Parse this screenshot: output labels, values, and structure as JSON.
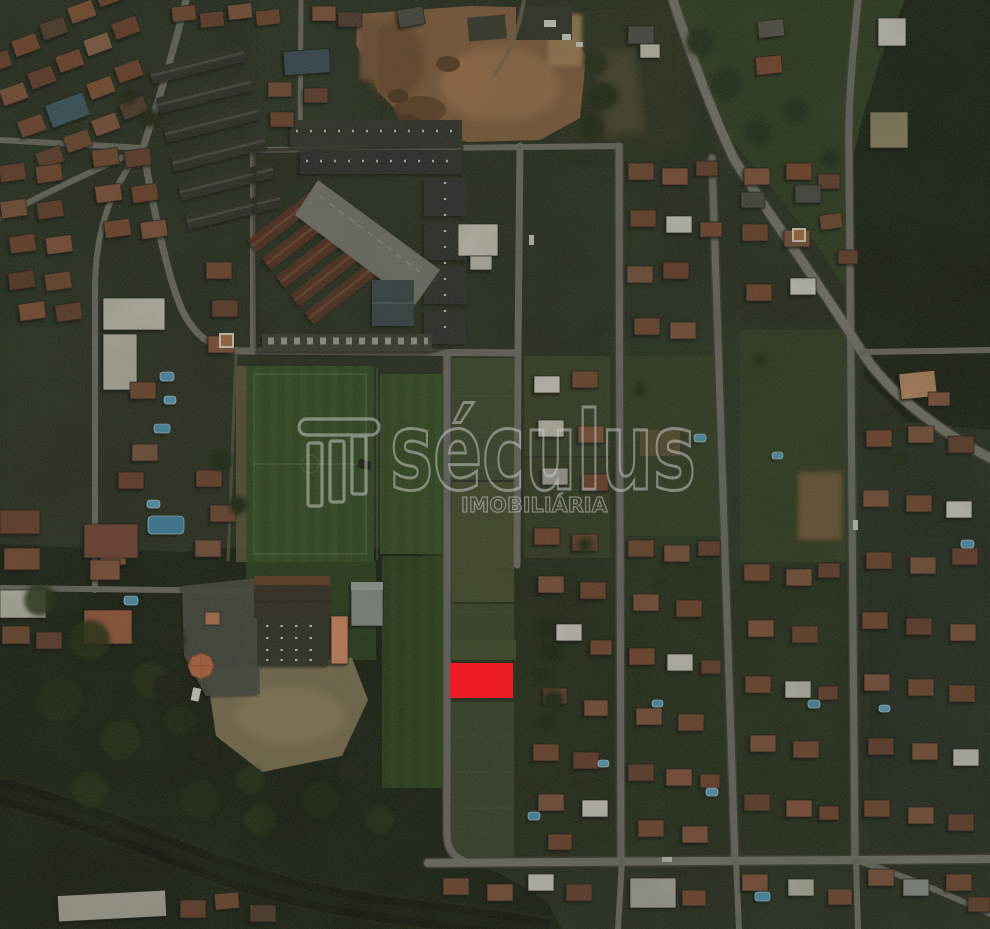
{
  "image": {
    "kind": "satellite-aerial-photo",
    "subject": "residential neighborhood with land lot highlighted for sale",
    "width": 990,
    "height": 929
  },
  "watermark": {
    "brand": "séculus",
    "subtitle": "IMOBILIÁRIA",
    "color": "#cccccc",
    "logo": "column-icon"
  },
  "marker": {
    "name": "highlighted-lot",
    "color": "#ed1c24",
    "x": 450,
    "y": 663,
    "width": 63,
    "height": 35
  },
  "palette": {
    "ground": "#232a1c",
    "forest": "#131a0d",
    "field": "#2f471f",
    "dirt": "#8a5e3e",
    "road": "#716f68",
    "water": "#0c100a",
    "roof_red": "#7a452f",
    "roof_white": "#d9d6cc",
    "pool_blue": "#4f9ec7"
  },
  "features": [
    {
      "name": "construction-dirt-area",
      "area": "top-center"
    },
    {
      "name": "apartment-row-complex",
      "area": "upper-left-center"
    },
    {
      "name": "townhouse-superblock",
      "area": "upper-center"
    },
    {
      "name": "soccer-fields",
      "area": "center-left"
    },
    {
      "name": "school-with-orange-gazebo",
      "area": "lower-left-center"
    },
    {
      "name": "river",
      "area": "bottom-left"
    },
    {
      "name": "forest",
      "area": "bottom-left-and-right-edge"
    },
    {
      "name": "residential-street-grid",
      "area": "right-half"
    },
    {
      "name": "highlighted-lot-marker",
      "area": "center"
    }
  ]
}
